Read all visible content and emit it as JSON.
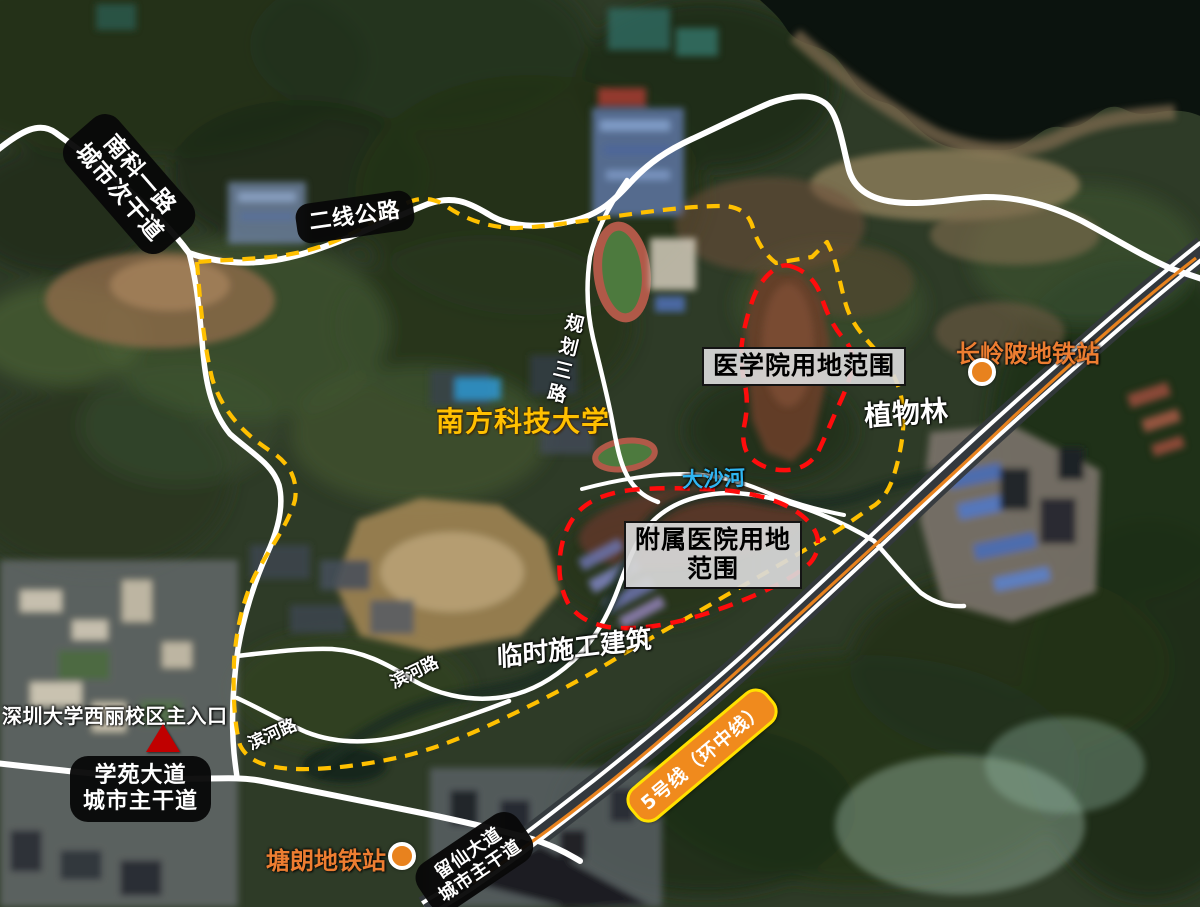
{
  "colors": {
    "campus_boundary": "#FFC000",
    "site_outline": "#FF0C0C",
    "road": "#FFFFFF",
    "metro_line": "#E8821E",
    "station_marker": "#E8821E",
    "station_text": "#ED7D31",
    "river_text": "#2FB5F2",
    "university_text": "#FFC000",
    "line5_badge_bg": "#F08A1D",
    "line5_badge_border": "#FFE100",
    "road_label_bg": "#080808",
    "site_label_bg": "#D9D9D9",
    "entrance_marker": "#C00000"
  },
  "roads": {
    "nanke": {
      "line1": "南科一路",
      "line2": "城市次干道"
    },
    "erxian": "二线公路",
    "guihua_sanlu": "规划三路",
    "binhe_upper": "滨河路",
    "binhe_lower": "滨河路",
    "xueyuan": {
      "line1": "学苑大道",
      "line2": "城市主干道"
    },
    "liuxian": {
      "line1": "留仙大道",
      "line2": "城市主干道"
    }
  },
  "sites": {
    "medical_school": "医学院用地范围",
    "hospital": {
      "line1": "附属医院用地",
      "line2": "范围"
    },
    "temp_construction": "临时施工建筑",
    "botanic_forest": "植物林"
  },
  "places": {
    "university": "南方科技大学",
    "river": "大沙河",
    "szu_entrance": "深圳大学西丽校区主入口"
  },
  "metro": {
    "line5_badge": "5号线（环中线）",
    "station_changlingpo": "长岭陂地铁站",
    "station_tanglang": "塘朗地铁站"
  }
}
